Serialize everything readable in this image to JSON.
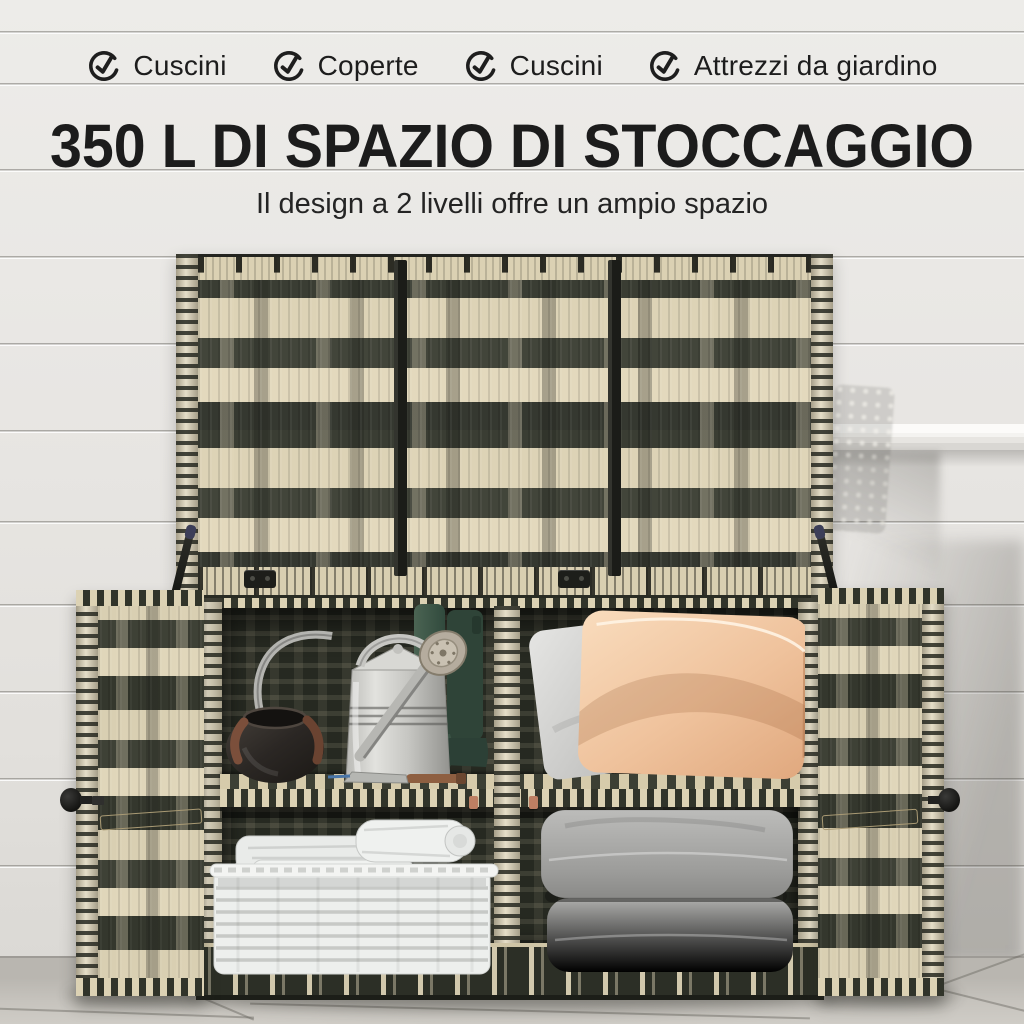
{
  "features": {
    "items": [
      {
        "label": "Cuscini",
        "icon": "check-circle-icon"
      },
      {
        "label": "Coperte",
        "icon": "check-circle-icon"
      },
      {
        "label": "Cuscini",
        "icon": "check-circle-icon"
      },
      {
        "label": "Attrezzi da giardino",
        "icon": "check-circle-icon"
      }
    ]
  },
  "headline": {
    "title": "350 L DI SPAZIO DI STOCCAGGIO",
    "subtitle": "Il design a 2 livelli offre un ampio spazio"
  },
  "scene": {
    "description": "Two-tone rattan outdoor storage cabinet with open lid and two open doors, two tiers of storage against a white shiplap wall on a stone tile floor",
    "objects": [
      "open-rattan-lid",
      "left-rattan-door",
      "right-rattan-door",
      "black-pot",
      "galvanized-watering-can",
      "green-rubber-boots",
      "garden-trowel",
      "gray-cushion",
      "peach-pillow",
      "white-wicker-basket",
      "white-towels",
      "stacked-gray-seat-cushions",
      "wall-shelf-ledge"
    ]
  },
  "palette": {
    "wall": "#e9e7e4",
    "floor": "#c2bfb9",
    "cream": "#ddd3b6",
    "dark": "#3e4136",
    "strap": "#1d1e1a",
    "text": "#1d1d1d",
    "peach": "#efc29c",
    "boot": "#3c5346",
    "cushion": "#a3a3a1",
    "basket": "#eef0ee"
  }
}
